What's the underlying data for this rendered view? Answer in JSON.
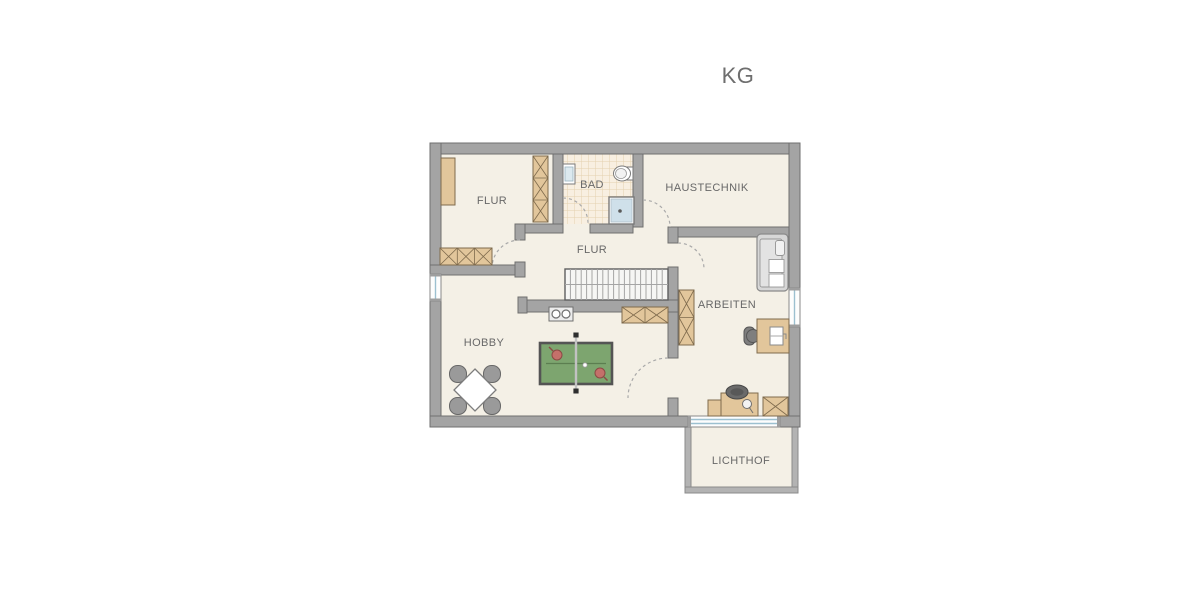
{
  "title": "KG",
  "rooms": {
    "flur_top": {
      "label": "FLUR"
    },
    "bad": {
      "label": "BAD"
    },
    "haustechnik": {
      "label": "HAUSTECHNIK"
    },
    "flur_mid": {
      "label": "FLUR"
    },
    "arbeiten": {
      "label": "ARBEITEN"
    },
    "hobby": {
      "label": "HOBBY"
    },
    "lichthof": {
      "label": "LICHTHOF"
    }
  },
  "symbols": [
    "sideboard-icon",
    "wardrobe-x-icon",
    "cabinet-x-icon",
    "sink-icon",
    "toilet-icon",
    "shower-icon",
    "stairs-icon",
    "door-swing-arc",
    "window-symbol",
    "laundry-basin-icon",
    "table-tennis-table-icon",
    "dining-table-with-chairs-icon",
    "sofa-icon",
    "desk-with-laptop-icon",
    "office-chair-icon",
    "boiler-icon",
    "pressure-gauge-icon"
  ],
  "palette": {
    "wall_gray": "#a4a4a4",
    "wall_outline": "#6f6f6f",
    "floor_beige": "#f4f0e6",
    "tile_beige": "#f8efe1",
    "tile_line": "#e4d1af",
    "furniture_tan": "#e2c69b",
    "furniture_tan_outline": "#7f6b4d",
    "tabletennis_green": "#7da56f",
    "paddle_red": "#c4706a",
    "window_blue": "#9cc0d0",
    "label_gray": "#686868"
  }
}
